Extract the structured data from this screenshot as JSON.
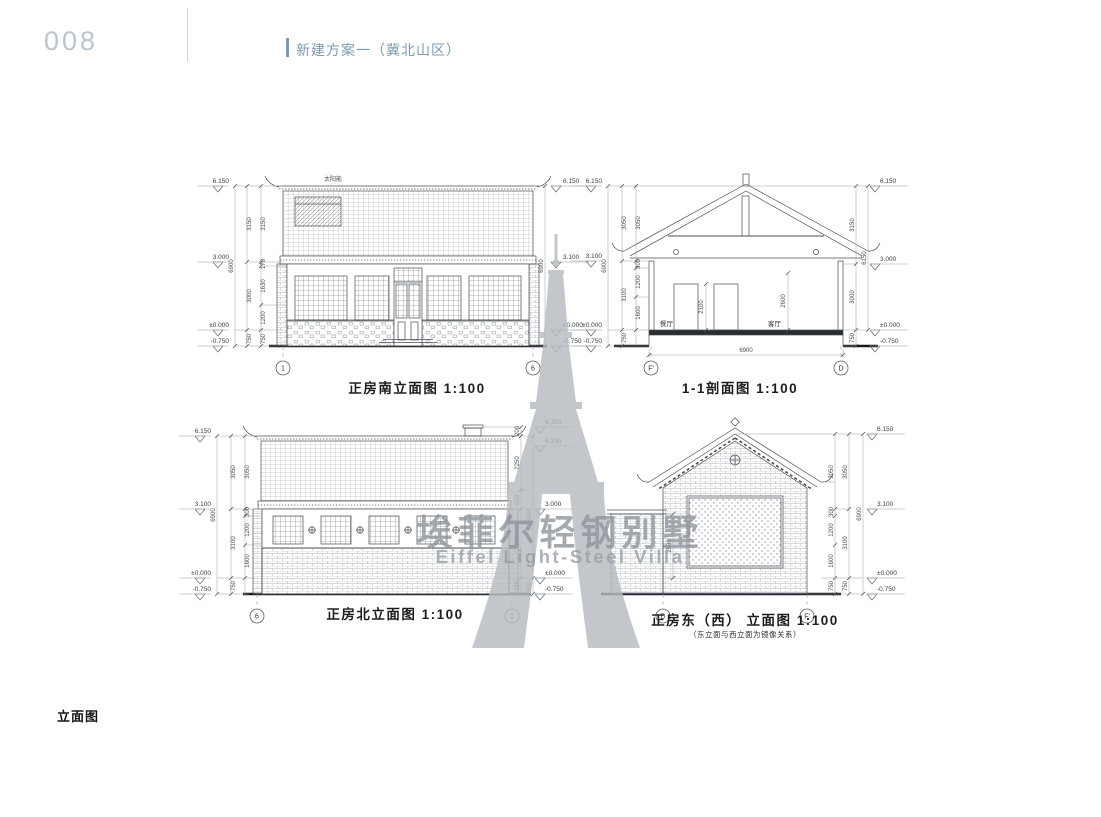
{
  "page": {
    "number": "008",
    "header_title": "新建方案一（冀北山区）",
    "footer_label": "立面图",
    "accent_color": "#7b9cb0",
    "page_number_color": "#b9c6cf"
  },
  "watermark": {
    "cn": "埃菲尔轻钢别墅",
    "en": "Eiffel Light-Steel Villa",
    "color": "#b7bbc0"
  },
  "d": {
    "south": {
      "title": "正房南立面图 1:100",
      "roof_label": "太阳能",
      "elev_left": [
        "6.150",
        "3.000",
        "±0.000",
        "-0.750"
      ],
      "elev_right": [
        "6.150",
        "3.100",
        "±0.000",
        "-0.750"
      ],
      "dims_inner": [
        "3150",
        "170",
        "1630",
        "1200",
        "750"
      ],
      "dims_outer": [
        "3150",
        "3000",
        "750"
      ],
      "total_left": "6900",
      "total_right": "6900",
      "bubble_left": "1",
      "bubble_right": "6"
    },
    "section": {
      "title": "1-1剖面图 1:100",
      "elev_left": [
        "6.150",
        "3.100",
        "±0.000",
        "-0.750"
      ],
      "elev_right": [
        "6.150",
        "3.000",
        "±0.000",
        "-0.750"
      ],
      "dims_inner": [
        "3050",
        "300",
        "1200",
        "1600"
      ],
      "dims_mid": [
        "3050",
        "3100",
        "750"
      ],
      "total_left": "6900",
      "dims_right": [
        "3150",
        "3000",
        "750"
      ],
      "total_right": "6150",
      "room_left": "餐厅",
      "room_right": "客厅",
      "dim_door": "2100",
      "dim_ceiling": "2600",
      "dim_width": "6900",
      "bubble_left": "F'",
      "bubble_right": "D"
    },
    "north": {
      "title": "正房北立面图 1:100",
      "elev_left": [
        "6.150",
        "3.100",
        "±0.000",
        "-0.750"
      ],
      "elev_right": [
        "6.350",
        "6.150",
        "3.000",
        "±0.000",
        "-0.750"
      ],
      "dims_inner": [
        "3050",
        "300",
        "1200",
        "1600"
      ],
      "dims_mid": [
        "3050",
        "3100",
        "750"
      ],
      "total_left": "6900",
      "dims_right": [
        "200",
        "2250",
        "600",
        "3000",
        "150"
      ],
      "dim_step": "500",
      "total_right": "6900",
      "bubble_left": "6",
      "bubble_right": "1"
    },
    "east": {
      "title": "正房东（西） 立面图 1:100",
      "subtitle": "（东立面与西立面为镜像关系）",
      "elev_right": [
        "6.150",
        "3.100",
        "±0.000",
        "-0.750"
      ],
      "dims_inner": [
        "3050",
        "300",
        "1200",
        "1600",
        "750"
      ],
      "dims_mid": [
        "3050",
        "3100",
        "750"
      ],
      "total_right": "6900",
      "dim_wall": "2500",
      "bubble_left": "D",
      "bubble_right": "F'"
    }
  }
}
